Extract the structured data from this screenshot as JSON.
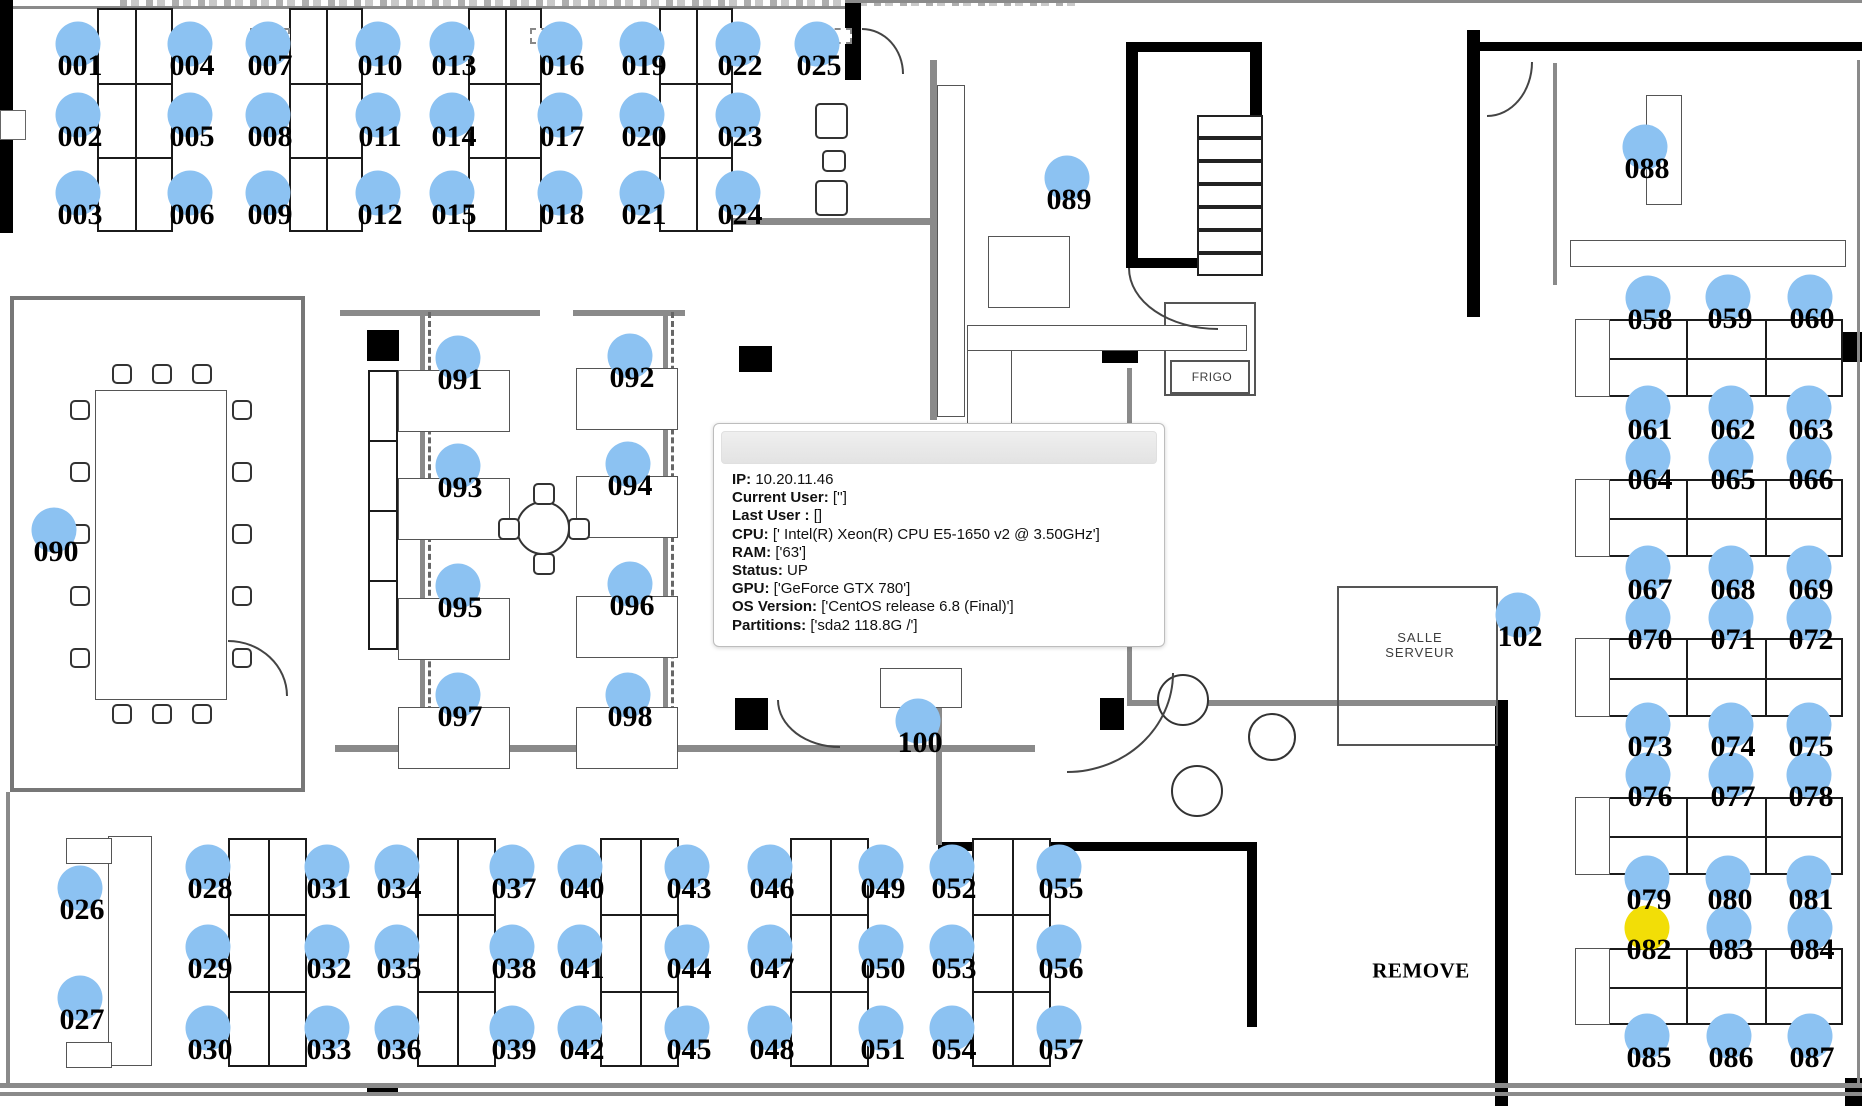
{
  "seat_colors": {
    "default": "#8CC2F2",
    "highlight": "#F2DE07"
  },
  "highlighted_seats": [
    "082"
  ],
  "seats": [
    {
      "id": "001",
      "x": 78,
      "y": 44
    },
    {
      "id": "002",
      "x": 78,
      "y": 115
    },
    {
      "id": "003",
      "x": 78,
      "y": 193
    },
    {
      "id": "004",
      "x": 190,
      "y": 44
    },
    {
      "id": "005",
      "x": 190,
      "y": 115
    },
    {
      "id": "006",
      "x": 190,
      "y": 193
    },
    {
      "id": "007",
      "x": 268,
      "y": 44
    },
    {
      "id": "008",
      "x": 268,
      "y": 115
    },
    {
      "id": "009",
      "x": 268,
      "y": 193
    },
    {
      "id": "010",
      "x": 378,
      "y": 44
    },
    {
      "id": "011",
      "x": 378,
      "y": 115
    },
    {
      "id": "012",
      "x": 378,
      "y": 193
    },
    {
      "id": "013",
      "x": 452,
      "y": 44
    },
    {
      "id": "014",
      "x": 452,
      "y": 115
    },
    {
      "id": "015",
      "x": 452,
      "y": 193
    },
    {
      "id": "016",
      "x": 560,
      "y": 44
    },
    {
      "id": "017",
      "x": 560,
      "y": 115
    },
    {
      "id": "018",
      "x": 560,
      "y": 193
    },
    {
      "id": "019",
      "x": 642,
      "y": 44
    },
    {
      "id": "020",
      "x": 642,
      "y": 115
    },
    {
      "id": "021",
      "x": 642,
      "y": 193
    },
    {
      "id": "022",
      "x": 738,
      "y": 44
    },
    {
      "id": "023",
      "x": 738,
      "y": 115
    },
    {
      "id": "024",
      "x": 738,
      "y": 193
    },
    {
      "id": "025",
      "x": 817,
      "y": 44
    },
    {
      "id": "026",
      "x": 80,
      "y": 888
    },
    {
      "id": "027",
      "x": 80,
      "y": 998
    },
    {
      "id": "028",
      "x": 208,
      "y": 867
    },
    {
      "id": "029",
      "x": 208,
      "y": 947
    },
    {
      "id": "030",
      "x": 208,
      "y": 1028
    },
    {
      "id": "031",
      "x": 327,
      "y": 867
    },
    {
      "id": "032",
      "x": 327,
      "y": 947
    },
    {
      "id": "033",
      "x": 327,
      "y": 1028
    },
    {
      "id": "034",
      "x": 397,
      "y": 867
    },
    {
      "id": "035",
      "x": 397,
      "y": 947
    },
    {
      "id": "036",
      "x": 397,
      "y": 1028
    },
    {
      "id": "037",
      "x": 512,
      "y": 867
    },
    {
      "id": "038",
      "x": 512,
      "y": 947
    },
    {
      "id": "039",
      "x": 512,
      "y": 1028
    },
    {
      "id": "040",
      "x": 580,
      "y": 867
    },
    {
      "id": "041",
      "x": 580,
      "y": 947
    },
    {
      "id": "042",
      "x": 580,
      "y": 1028
    },
    {
      "id": "043",
      "x": 687,
      "y": 867
    },
    {
      "id": "044",
      "x": 687,
      "y": 947
    },
    {
      "id": "045",
      "x": 687,
      "y": 1028
    },
    {
      "id": "046",
      "x": 770,
      "y": 867
    },
    {
      "id": "047",
      "x": 770,
      "y": 947
    },
    {
      "id": "048",
      "x": 770,
      "y": 1028
    },
    {
      "id": "049",
      "x": 881,
      "y": 867
    },
    {
      "id": "050",
      "x": 881,
      "y": 947
    },
    {
      "id": "051",
      "x": 881,
      "y": 1028
    },
    {
      "id": "052",
      "x": 952,
      "y": 867
    },
    {
      "id": "053",
      "x": 952,
      "y": 947
    },
    {
      "id": "054",
      "x": 952,
      "y": 1028
    },
    {
      "id": "055",
      "x": 1059,
      "y": 867
    },
    {
      "id": "056",
      "x": 1059,
      "y": 947
    },
    {
      "id": "057",
      "x": 1059,
      "y": 1028
    },
    {
      "id": "058",
      "x": 1648,
      "y": 298
    },
    {
      "id": "059",
      "x": 1728,
      "y": 297
    },
    {
      "id": "060",
      "x": 1810,
      "y": 297
    },
    {
      "id": "061",
      "x": 1648,
      "y": 408
    },
    {
      "id": "062",
      "x": 1731,
      "y": 408
    },
    {
      "id": "063",
      "x": 1809,
      "y": 408
    },
    {
      "id": "064",
      "x": 1648,
      "y": 458
    },
    {
      "id": "065",
      "x": 1731,
      "y": 458
    },
    {
      "id": "066",
      "x": 1809,
      "y": 458
    },
    {
      "id": "067",
      "x": 1648,
      "y": 568
    },
    {
      "id": "068",
      "x": 1731,
      "y": 568
    },
    {
      "id": "069",
      "x": 1809,
      "y": 568
    },
    {
      "id": "070",
      "x": 1648,
      "y": 618
    },
    {
      "id": "071",
      "x": 1731,
      "y": 618
    },
    {
      "id": "072",
      "x": 1809,
      "y": 618
    },
    {
      "id": "073",
      "x": 1648,
      "y": 725
    },
    {
      "id": "074",
      "x": 1731,
      "y": 725
    },
    {
      "id": "075",
      "x": 1809,
      "y": 725
    },
    {
      "id": "076",
      "x": 1648,
      "y": 775
    },
    {
      "id": "077",
      "x": 1731,
      "y": 775
    },
    {
      "id": "078",
      "x": 1809,
      "y": 775
    },
    {
      "id": "079",
      "x": 1647,
      "y": 878
    },
    {
      "id": "080",
      "x": 1728,
      "y": 878
    },
    {
      "id": "081",
      "x": 1809,
      "y": 878
    },
    {
      "id": "082",
      "x": 1647,
      "y": 928
    },
    {
      "id": "083",
      "x": 1729,
      "y": 928
    },
    {
      "id": "084",
      "x": 1810,
      "y": 928
    },
    {
      "id": "085",
      "x": 1647,
      "y": 1036
    },
    {
      "id": "086",
      "x": 1729,
      "y": 1036
    },
    {
      "id": "087",
      "x": 1810,
      "y": 1036
    },
    {
      "id": "088",
      "x": 1645,
      "y": 147
    },
    {
      "id": "089",
      "x": 1067,
      "y": 178
    },
    {
      "id": "090",
      "x": 54,
      "y": 530
    },
    {
      "id": "091",
      "x": 458,
      "y": 358
    },
    {
      "id": "092",
      "x": 630,
      "y": 356
    },
    {
      "id": "093",
      "x": 458,
      "y": 466
    },
    {
      "id": "094",
      "x": 628,
      "y": 464
    },
    {
      "id": "095",
      "x": 458,
      "y": 586
    },
    {
      "id": "096",
      "x": 630,
      "y": 584
    },
    {
      "id": "097",
      "x": 458,
      "y": 695
    },
    {
      "id": "098",
      "x": 628,
      "y": 695
    },
    {
      "id": "100",
      "x": 918,
      "y": 721
    },
    {
      "id": "102",
      "x": 1518,
      "y": 615
    }
  ],
  "floor_labels": [
    {
      "name": "frigo-label",
      "text": "FRIGO",
      "x": 1212,
      "y": 377,
      "size": 12,
      "serif": false,
      "spacing": "0.5px"
    },
    {
      "name": "salle-serveur-label",
      "text": "SALLE\nSERVEUR",
      "x": 1420,
      "y": 645,
      "size": 13,
      "serif": false,
      "spacing": "1px"
    },
    {
      "name": "remove-label",
      "text": "REMOVE",
      "x": 1421,
      "y": 971,
      "size": 21,
      "serif": true,
      "spacing": "0.5px"
    }
  ],
  "tooltip": {
    "x": 713,
    "y": 423,
    "width": 452,
    "height": 224,
    "title": "",
    "fields": [
      {
        "label": "IP:",
        "value": "10.20.11.46"
      },
      {
        "label": "Current User:",
        "value": "['']"
      },
      {
        "label": "Last User :",
        "value": "[]"
      },
      {
        "label": "CPU:",
        "value": "[' Intel(R) Xeon(R) CPU E5-1650 v2 @ 3.50GHz']"
      },
      {
        "label": "RAM:",
        "value": "['63']"
      },
      {
        "label": "Status:",
        "value": "UP"
      },
      {
        "label": "GPU:",
        "value": "['GeForce GTX 780']"
      },
      {
        "label": "OS Version:",
        "value": "['CentOS release 6.8 (Final)']"
      },
      {
        "label": "Partitions:",
        "value": "['sda2 118.8G /']"
      }
    ]
  }
}
